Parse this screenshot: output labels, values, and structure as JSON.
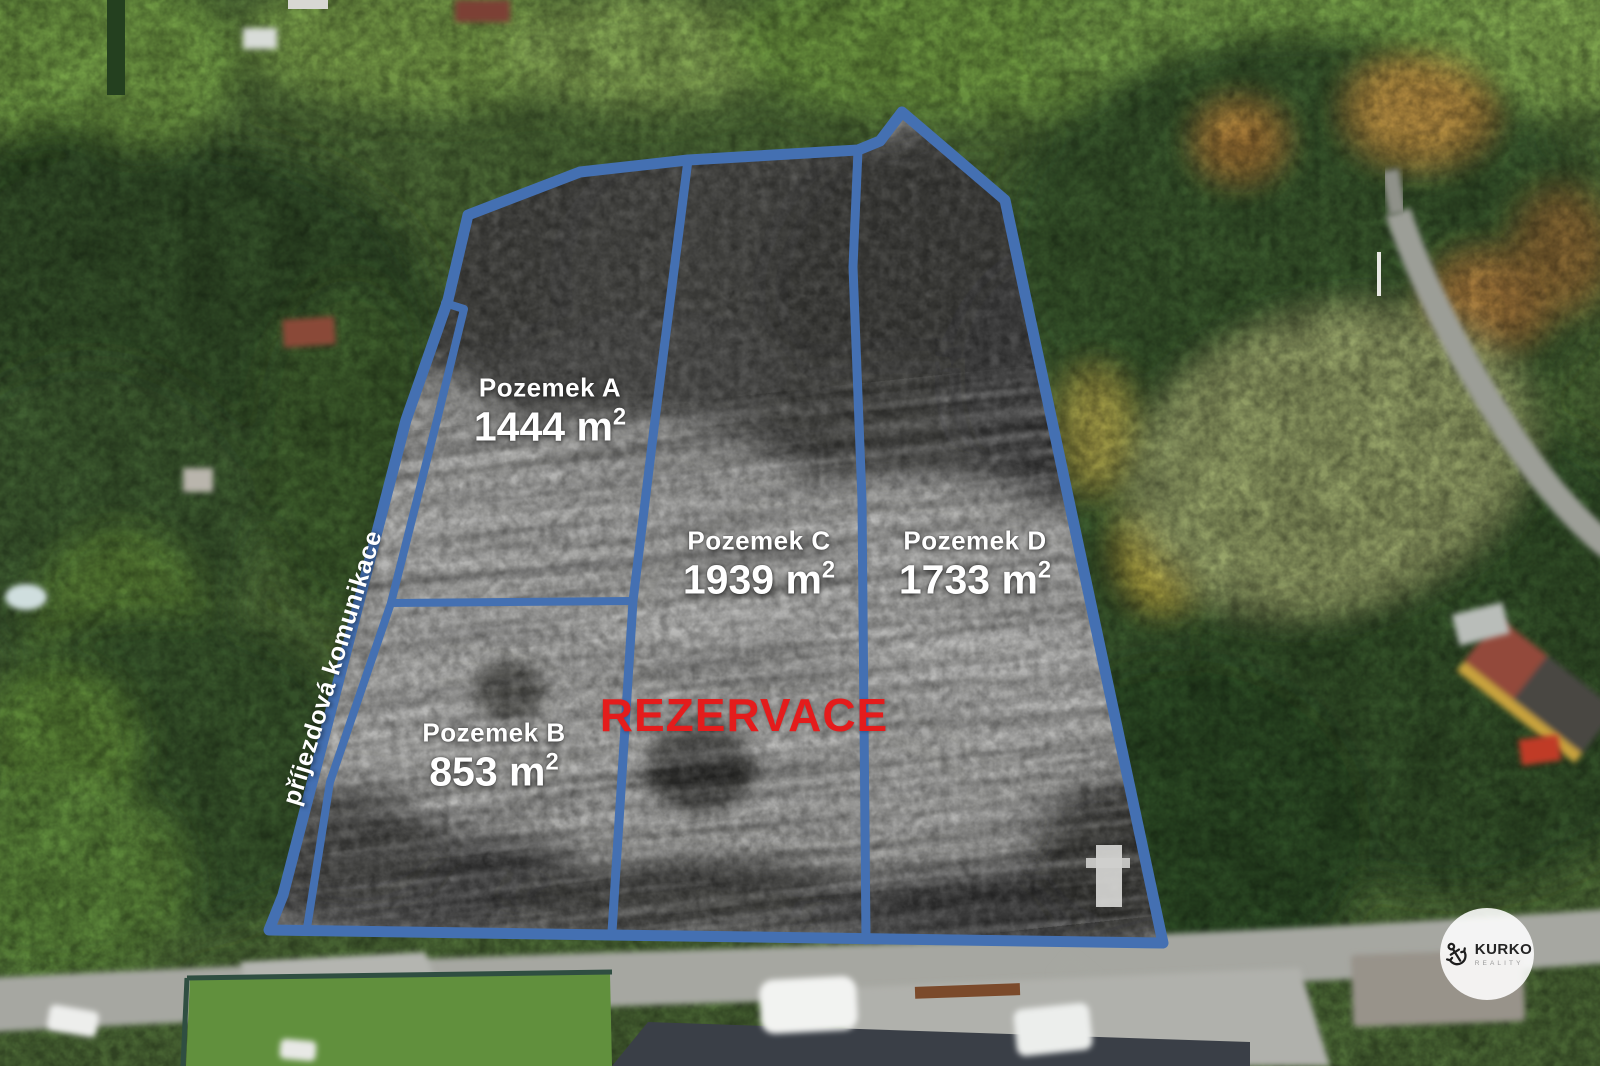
{
  "overlay": {
    "boundary_color": "#4470b2",
    "label_color": "#ffffff",
    "parcels": [
      {
        "name": "Pozemek A",
        "area": "1444 m²"
      },
      {
        "name": "Pozemek B",
        "area": "853 m²"
      },
      {
        "name": "Pozemek C",
        "area": "1939 m²"
      },
      {
        "name": "Pozemek D",
        "area": "1733 m²"
      }
    ],
    "reservation_label": "REZERVACE",
    "reservation_color": "#e41c1c",
    "road_label": "příjezdová komunikace"
  },
  "logo": {
    "brand": "KURKO",
    "subtitle": "REALITY",
    "icon": "anchor-icon"
  }
}
